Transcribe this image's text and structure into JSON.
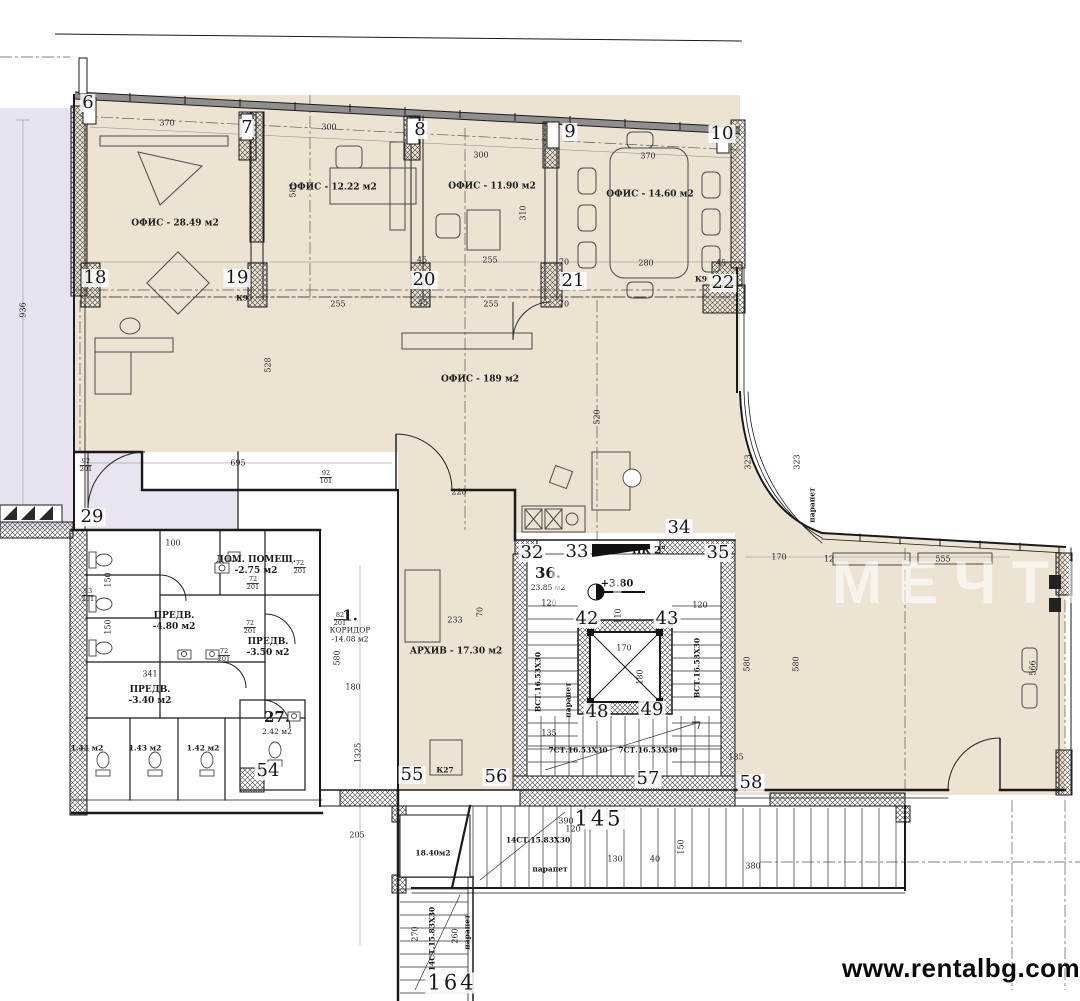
{
  "colors": {
    "floor_fill": "#ece3d3",
    "terrace_fill": "#e9e2f0",
    "vestibule_fill": "#eae4f1",
    "wall": "#1a1a1a",
    "url_text_color": "#0a0a0a"
  },
  "watermark": {
    "url_text": "www.rentalbg.com",
    "faint_left": "ВТ",
    "faint_right": "МЕЧТИ"
  },
  "rooms": [
    {
      "id": "office-2849",
      "lines": [
        "ОФИС - 28.49 м2"
      ],
      "x": 175,
      "y": 224
    },
    {
      "id": "office-1222",
      "lines": [
        "ОФИС - 12.22 м2"
      ],
      "x": 333,
      "y": 188
    },
    {
      "id": "office-1190",
      "lines": [
        "ОФИС - 11.90 м2"
      ],
      "x": 492,
      "y": 187
    },
    {
      "id": "office-1460",
      "lines": [
        "ОФИС - 14.60 м2"
      ],
      "x": 650,
      "y": 195
    },
    {
      "id": "office-189",
      "lines": [
        "ОФИС - 189 м2"
      ],
      "x": 480,
      "y": 380
    },
    {
      "id": "archive",
      "lines": [
        "АРХИВ - 17.30 м2"
      ],
      "x": 456,
      "y": 652
    },
    {
      "id": "corridor-1",
      "lines": [
        "1.",
        "КОРИДОР",
        "-14.08 м2"
      ],
      "x": 350,
      "y": 625,
      "big": true
    },
    {
      "id": "dom-pomesht",
      "lines": [
        "ДОМ. ПОМЕЩ.",
        "-2.75 м2"
      ],
      "x": 256,
      "y": 566
    },
    {
      "id": "predv-480",
      "lines": [
        "ПРЕДВ.",
        "-4.80 м2"
      ],
      "x": 174,
      "y": 622
    },
    {
      "id": "predv-350",
      "lines": [
        "ПРЕДВ.",
        "-3.50 м2"
      ],
      "x": 268,
      "y": 648
    },
    {
      "id": "predv-340",
      "lines": [
        "ПРЕДВ.",
        "-3.40 м2"
      ],
      "x": 150,
      "y": 696
    },
    {
      "id": "room-36",
      "lines": [
        "36.",
        "23.85 м2"
      ],
      "x": 548,
      "y": 578,
      "big": true
    },
    {
      "id": "room-27",
      "lines": [
        "27.",
        "2.42 м2"
      ],
      "x": 277,
      "y": 722,
      "big": true
    },
    {
      "id": "stair-room-1840",
      "lines": [
        "18.40м2"
      ],
      "x": 433,
      "y": 853,
      "small": true
    },
    {
      "id": "wc-144",
      "lines": [
        "1.44 м2"
      ],
      "x": 87,
      "y": 748,
      "small": true
    },
    {
      "id": "wc-143",
      "lines": [
        "1.43 м2"
      ],
      "x": 145,
      "y": 748,
      "small": true
    },
    {
      "id": "wc-142",
      "lines": [
        "1.42 м2"
      ],
      "x": 203,
      "y": 748,
      "small": true
    }
  ],
  "grid_markers": [
    {
      "n": "6",
      "x": 88,
      "y": 103
    },
    {
      "n": "7",
      "x": 247,
      "y": 128
    },
    {
      "n": "8",
      "x": 420,
      "y": 130
    },
    {
      "n": "9",
      "x": 570,
      "y": 132
    },
    {
      "n": "10",
      "x": 722,
      "y": 134
    },
    {
      "n": "18",
      "x": 95,
      "y": 278
    },
    {
      "n": "19",
      "x": 237,
      "y": 278
    },
    {
      "n": "20",
      "x": 424,
      "y": 280
    },
    {
      "n": "21",
      "x": 573,
      "y": 281
    },
    {
      "n": "22",
      "x": 723,
      "y": 283
    },
    {
      "n": "29",
      "x": 92,
      "y": 517
    },
    {
      "n": "32",
      "x": 532,
      "y": 553
    },
    {
      "n": "33",
      "x": 577,
      "y": 552
    },
    {
      "n": "34",
      "x": 679,
      "y": 528
    },
    {
      "n": "35",
      "x": 718,
      "y": 553
    },
    {
      "n": "42",
      "x": 587,
      "y": 619
    },
    {
      "n": "43",
      "x": 667,
      "y": 619
    },
    {
      "n": "48",
      "x": 597,
      "y": 712
    },
    {
      "n": "49",
      "x": 652,
      "y": 710
    },
    {
      "n": "54",
      "x": 268,
      "y": 771
    },
    {
      "n": "55",
      "x": 412,
      "y": 775
    },
    {
      "n": "56",
      "x": 496,
      "y": 777
    },
    {
      "n": "57",
      "x": 648,
      "y": 779
    },
    {
      "n": "58",
      "x": 751,
      "y": 783
    },
    {
      "n": "145",
      "x": 599,
      "y": 819
    },
    {
      "n": "164",
      "x": 452,
      "y": 983
    }
  ],
  "dimensions": [
    {
      "t": "370",
      "x": 167,
      "y": 123
    },
    {
      "t": "300",
      "x": 329,
      "y": 127
    },
    {
      "t": "581",
      "x": 293,
      "y": 190,
      "v": 1
    },
    {
      "t": "310",
      "x": 523,
      "y": 213,
      "v": 1
    },
    {
      "t": "300",
      "x": 481,
      "y": 155
    },
    {
      "t": "370",
      "x": 648,
      "y": 156
    },
    {
      "t": "45",
      "x": 422,
      "y": 260
    },
    {
      "t": "255",
      "x": 490,
      "y": 260
    },
    {
      "t": "70",
      "x": 564,
      "y": 262
    },
    {
      "t": "280",
      "x": 646,
      "y": 263
    },
    {
      "t": "45",
      "x": 721,
      "y": 263
    },
    {
      "t": "255",
      "x": 338,
      "y": 304
    },
    {
      "t": "45",
      "x": 423,
      "y": 303
    },
    {
      "t": "255",
      "x": 491,
      "y": 304
    },
    {
      "t": "70",
      "x": 564,
      "y": 304
    },
    {
      "t": "936",
      "x": 23,
      "y": 310,
      "v": 1
    },
    {
      "t": "528",
      "x": 268,
      "y": 365,
      "v": 1
    },
    {
      "t": "695",
      "x": 238,
      "y": 463
    },
    {
      "t": "520",
      "x": 597,
      "y": 417,
      "v": 1
    },
    {
      "t": "220",
      "x": 459,
      "y": 492
    },
    {
      "t": "100",
      "x": 173,
      "y": 543
    },
    {
      "t": "341",
      "x": 150,
      "y": 674
    },
    {
      "t": "150",
      "x": 108,
      "y": 580,
      "v": 1
    },
    {
      "t": "150",
      "x": 108,
      "y": 627,
      "v": 1
    },
    {
      "t": "233",
      "x": 455,
      "y": 620
    },
    {
      "t": "70",
      "x": 480,
      "y": 612,
      "v": 1
    },
    {
      "t": "580",
      "x": 337,
      "y": 658,
      "v": 1
    },
    {
      "t": "180",
      "x": 353,
      "y": 687
    },
    {
      "t": "1325",
      "x": 358,
      "y": 753,
      "v": 1
    },
    {
      "t": "120",
      "x": 549,
      "y": 603
    },
    {
      "t": "120",
      "x": 700,
      "y": 605
    },
    {
      "t": "110",
      "x": 618,
      "y": 616,
      "v": 1
    },
    {
      "t": "170",
      "x": 624,
      "y": 648
    },
    {
      "t": "180",
      "x": 640,
      "y": 677,
      "v": 1
    },
    {
      "t": "135",
      "x": 549,
      "y": 733
    },
    {
      "t": "135",
      "x": 736,
      "y": 757
    },
    {
      "t": "390",
      "x": 566,
      "y": 821
    },
    {
      "t": "120",
      "x": 573,
      "y": 829
    },
    {
      "t": "130",
      "x": 615,
      "y": 859
    },
    {
      "t": "40",
      "x": 655,
      "y": 859
    },
    {
      "t": "150",
      "x": 681,
      "y": 847,
      "v": 1
    },
    {
      "t": "205",
      "x": 357,
      "y": 835
    },
    {
      "t": "270",
      "x": 415,
      "y": 934,
      "v": 1
    },
    {
      "t": "260",
      "x": 455,
      "y": 936,
      "v": 1
    },
    {
      "t": "170",
      "x": 779,
      "y": 557
    },
    {
      "t": "12",
      "x": 829,
      "y": 559
    },
    {
      "t": "555",
      "x": 943,
      "y": 559
    },
    {
      "t": "580",
      "x": 747,
      "y": 664,
      "v": 1
    },
    {
      "t": "580",
      "x": 796,
      "y": 664,
      "v": 1
    },
    {
      "t": "566",
      "x": 1033,
      "y": 668,
      "v": 1
    },
    {
      "t": "323",
      "x": 748,
      "y": 462,
      "v": 1
    },
    {
      "t": "323",
      "x": 797,
      "y": 462,
      "v": 1
    },
    {
      "t": "380",
      "x": 753,
      "y": 866
    }
  ],
  "annotations": [
    {
      "t": "ПК 2°",
      "x": 649,
      "y": 551,
      "lg": 1
    },
    {
      "t": "+3.80",
      "x": 617,
      "y": 584,
      "lg": 1
    },
    {
      "t": "К27",
      "x": 445,
      "y": 770
    },
    {
      "t": "К9",
      "x": 701,
      "y": 279
    },
    {
      "t": "К9",
      "x": 242,
      "y": 298
    },
    {
      "t": "7СТ.16.53X30",
      "x": 578,
      "y": 750
    },
    {
      "t": "7СТ.16.53X30",
      "x": 648,
      "y": 750
    },
    {
      "t": "ВСТ.16.53X30",
      "x": 538,
      "y": 682,
      "v": 1
    },
    {
      "t": "ВСТ.16.53X30",
      "x": 697,
      "y": 668,
      "v": 1
    },
    {
      "t": "14СТ.15.83X30",
      "x": 538,
      "y": 840
    },
    {
      "t": "14СТ.15.83X30",
      "x": 432,
      "y": 939,
      "v": 1
    },
    {
      "t": "парапет",
      "x": 812,
      "y": 505,
      "v": 1
    },
    {
      "t": "парапет",
      "x": 568,
      "y": 700,
      "v": 1
    },
    {
      "t": "парапет",
      "x": 550,
      "y": 869
    },
    {
      "t": "парапет",
      "x": 467,
      "y": 932,
      "v": 1
    }
  ],
  "door_tags": [
    {
      "n": "72",
      "s": "201",
      "x": 253,
      "y": 584
    },
    {
      "n": "72",
      "s": "201",
      "x": 250,
      "y": 628
    },
    {
      "n": "72",
      "s": "201",
      "x": 224,
      "y": 656
    },
    {
      "n": "82",
      "s": "201",
      "x": 340,
      "y": 620
    },
    {
      "n": "93",
      "s": "201",
      "x": 88,
      "y": 596
    },
    {
      "n": "92",
      "s": "201",
      "x": 86,
      "y": 466
    },
    {
      "n": "92",
      "s": "101",
      "x": 326,
      "y": 478
    },
    {
      "n": "72",
      "s": "201",
      "x": 300,
      "y": 568
    }
  ]
}
